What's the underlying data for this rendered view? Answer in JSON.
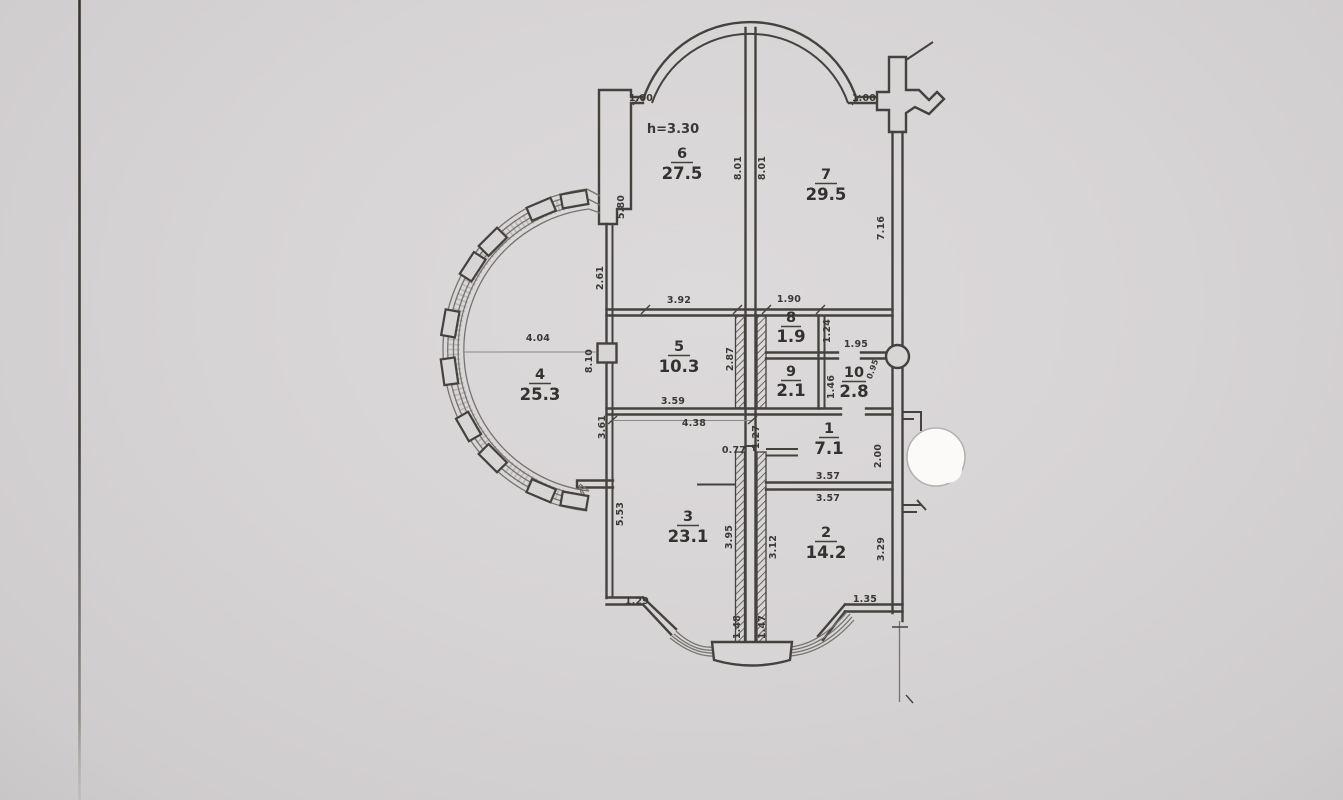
{
  "document": {
    "type": "apartment floor plan (scanned drawing)",
    "colors": {
      "paper": "#d7d4d5",
      "ink": "#45423e",
      "whiteout": "#fbfaf8"
    }
  },
  "annotations": {
    "ceiling_height": "h=3.30"
  },
  "rooms": [
    {
      "number": "1",
      "area": "7.1"
    },
    {
      "number": "2",
      "area": "14.2"
    },
    {
      "number": "3",
      "area": "23.1"
    },
    {
      "number": "4",
      "area": "25.3"
    },
    {
      "number": "5",
      "area": "10.3"
    },
    {
      "number": "6",
      "area": "27.5"
    },
    {
      "number": "7",
      "area": "29.5"
    },
    {
      "number": "8",
      "area": "1.9"
    },
    {
      "number": "9",
      "area": "2.1"
    },
    {
      "number": "10",
      "area": "2.8"
    }
  ],
  "dims": [
    "1.00",
    "1.00",
    "8.01",
    "8.01",
    "7.16",
    "5.80",
    "2.61",
    "8.10",
    "4.04",
    "3.61",
    "3.92",
    "1.90",
    "1.24",
    "2.87",
    "1.95",
    "0.95",
    "1.46",
    "3.59",
    "4.38",
    "0.77",
    "1.27",
    "2.00",
    "3.57",
    "3.57",
    "5.53",
    "3.95",
    "3.12",
    "3.29",
    "1.29",
    "1.48",
    "1.47",
    "1.35"
  ]
}
